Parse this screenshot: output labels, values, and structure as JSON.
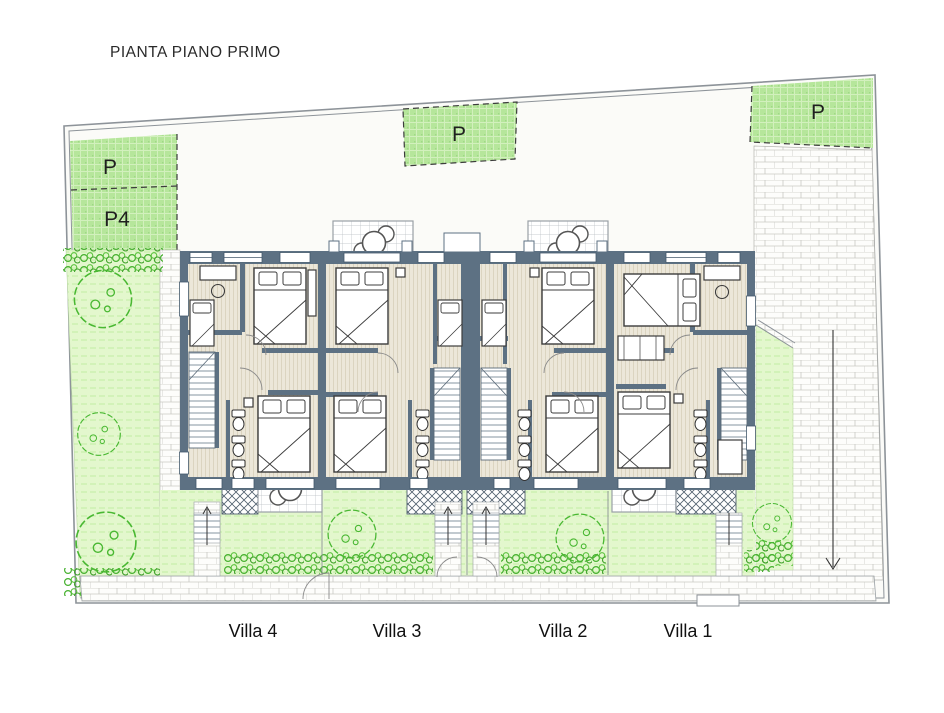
{
  "title": "PIANTA PIANO PRIMO",
  "parking_areas": [
    {
      "id": "top-left",
      "label": "P"
    },
    {
      "id": "top-left-lower",
      "label": "P4"
    },
    {
      "id": "top-middle",
      "label": "P"
    },
    {
      "id": "top-right",
      "label": "P"
    }
  ],
  "villas": [
    {
      "label": "Villa 4"
    },
    {
      "label": "Villa 3"
    },
    {
      "label": "Villa 2"
    },
    {
      "label": "Villa 1"
    }
  ],
  "icons": {
    "tree": "tree-icon",
    "hedge": "hedge-icon",
    "round_table": "table-icon",
    "bed": "bed-icon",
    "stairs": "stairs-icon",
    "toilet": "toilet-icon",
    "arrow": "direction-arrow-icon"
  },
  "colors": {
    "wall": "#5d7183",
    "parking_green": "#b6e69b",
    "lawn_green": "#e3f7cd",
    "hedge_green": "#45b02e",
    "floor_cream": "#ece7d9",
    "boundary_grey": "#8d9399",
    "text": "#1f1f1f"
  }
}
